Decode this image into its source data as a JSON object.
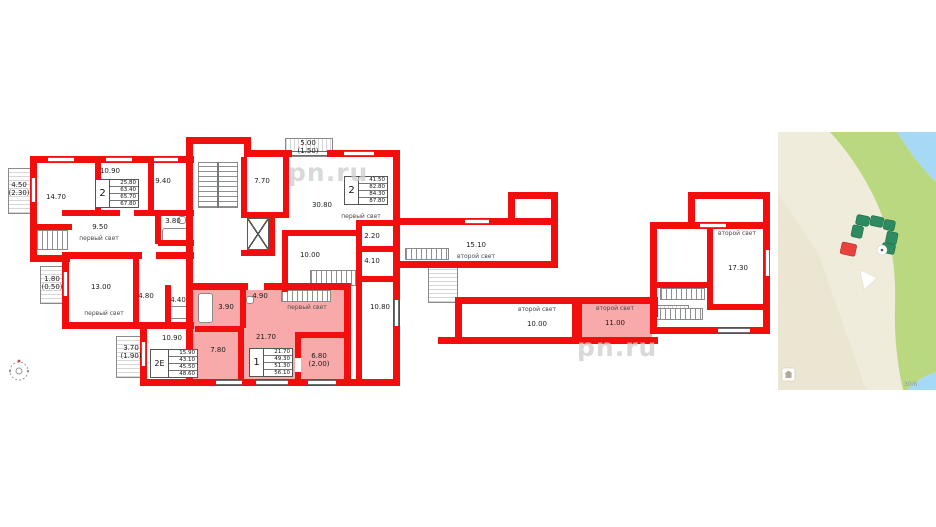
{
  "plan": {
    "watermark": "pn.ru",
    "lights": {
      "first": "первый свет",
      "second": "второй свет"
    },
    "rooms": {
      "balcony_a": "4.50\n(2.30)",
      "r1470": "14.70",
      "r1090a": "10.90",
      "r940": "9.40",
      "r950": "9.50",
      "r380": "3.80",
      "balcony_b": "5.00\n(1.50)",
      "r770": "7.70",
      "r3080": "30.80",
      "r220": "2.20",
      "r410": "4.10",
      "r1080": "10.80",
      "r1000a": "10.00",
      "balcony_c": "1.80\n(0.50)",
      "r1300": "13.00",
      "r480": "4.80",
      "r440": "4.40",
      "r1090b": "10.90",
      "balcony_d": "3.70\n(1.90)",
      "r390": "3.90",
      "r490": "4.90",
      "r780": "7.80",
      "r2170": "21.70",
      "terrace": "6.80\n(2.00)",
      "r1510": "15.10",
      "r1000b": "10.00",
      "r1100": "11.00",
      "r1730": "17.30"
    },
    "units": {
      "u1": {
        "type": "2",
        "rows": [
          "25.80",
          "63.40",
          "65.70",
          "67.80"
        ]
      },
      "u2": {
        "type": "2",
        "rows": [
          "41.50",
          "82.80",
          "84.30",
          "87.80"
        ]
      },
      "u3": {
        "type": "2Е",
        "rows": [
          "15.90",
          "43.10",
          "45.50",
          "48.60"
        ]
      },
      "u4": {
        "type": "1",
        "rows": [
          "21.70",
          "49.30",
          "51.30",
          "56.10"
        ]
      }
    }
  },
  "map": {
    "plot_label": "30/6"
  },
  "colors": {
    "wall": "#f30e0e",
    "highlight": "#f8a9a9",
    "map_land": "#f0ecdc",
    "map_green": "#b9d87f",
    "map_water": "#a6d9f4",
    "map_building": "#2e8a60",
    "map_highlight": "#e8423e"
  }
}
